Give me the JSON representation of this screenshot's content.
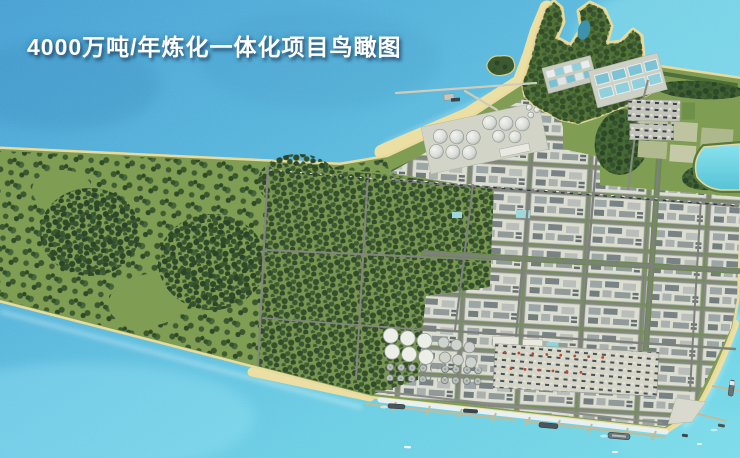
{
  "title": {
    "text": "4000万吨/年炼化一体化项目鸟瞰图"
  },
  "scene": {
    "kind": "aerial-rendering",
    "subject": "refining-petrochemical-integration-complex",
    "colors": {
      "water_deep": "#3d9cd1",
      "water_light": "#6fd8e6",
      "beach_sand": "#ecdfa4",
      "field_green": "#7f9d53",
      "forest_green": "#3a5730",
      "industrial_ground": "#d6d6c8",
      "road_gray": "#7d817b",
      "title_text": "#ffffff"
    }
  }
}
